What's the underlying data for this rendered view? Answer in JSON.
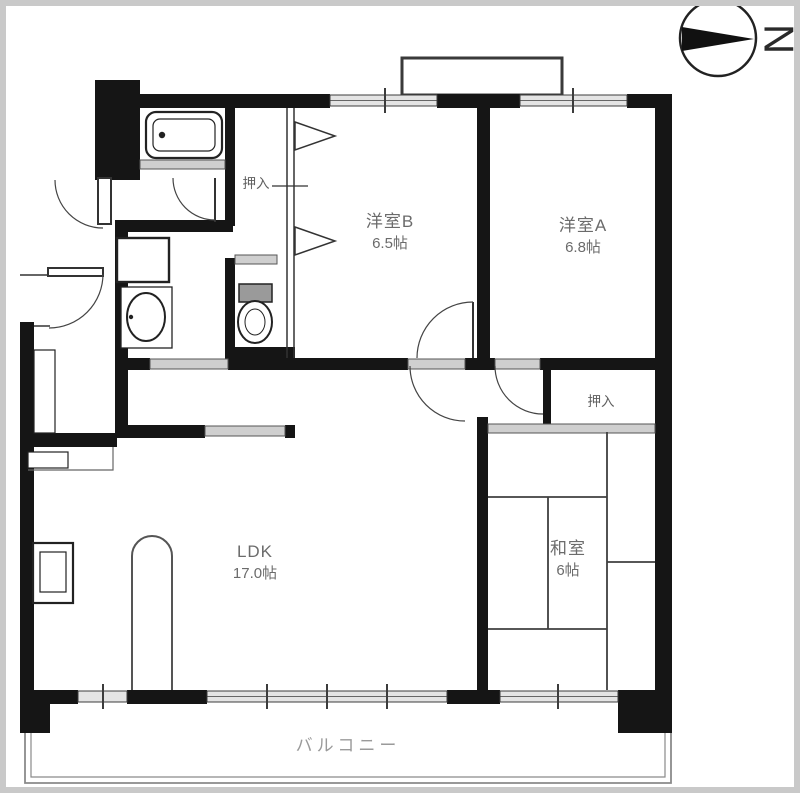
{
  "compass": {
    "letter": "N"
  },
  "rooms": {
    "western_b": {
      "name": "洋室B",
      "size": "6.5帖"
    },
    "western_a": {
      "name": "洋室A",
      "size": "6.8帖"
    },
    "ldk": {
      "name": "LDK",
      "size": "17.0帖"
    },
    "japanese": {
      "name": "和室",
      "size": "6帖"
    }
  },
  "closets": [
    {
      "label": "押入"
    },
    {
      "label": "押入"
    }
  ],
  "balcony": {
    "label": "バルコニー"
  },
  "colors": {
    "wall": "#151515",
    "thin_line": "#333333",
    "window_fill": "#e4e4e4",
    "slider_fill": "#cfcfcf",
    "room_label": "#6b6b6b",
    "balcony_label": "#9a9a9a",
    "page_frame": "#c9c9c9"
  }
}
